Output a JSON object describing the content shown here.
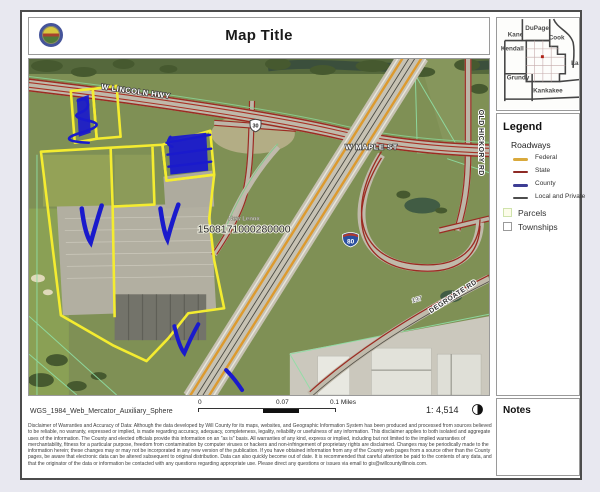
{
  "window": {
    "background": "#e8e8f0"
  },
  "header": {
    "title": "Map Title",
    "seal_icon": "will-county-seal-icon"
  },
  "map": {
    "labels": {
      "lincoln_hwy": "W LINCOLN HWY",
      "maple_st": "W MAPLE ST",
      "old_hickory_rd": "OLD HICKORY RD",
      "degroate_rd": "DEGROATE RD",
      "route_137": "137",
      "township": "New Lenox",
      "parcel_number": "1508171000280000"
    },
    "shields": {
      "us_route": "30",
      "interstate": "80"
    },
    "annotation_color": "#1a1acc",
    "parcel_highlight_color": "#f4ec30"
  },
  "sidebar": {
    "inset": {
      "counties": [
        "DuPage",
        "Kane",
        "Cook",
        "Kendall",
        "Lake",
        "Grundy",
        "Kankakee"
      ],
      "marker_color": "#b02418"
    },
    "legend": {
      "title": "Legend",
      "group_title": "Roadways",
      "roadway_items": [
        {
          "label": "Federal",
          "color": "#d9a93c"
        },
        {
          "label": "State",
          "color": "#8e2a25"
        },
        {
          "label": "County",
          "color": "#3d3d94"
        },
        {
          "label": "Local and Private",
          "color": "#4d4d4d"
        }
      ],
      "parcels_label": "Parcels",
      "townships_label": "Townships"
    },
    "notes": {
      "title": "Notes"
    }
  },
  "footer": {
    "projection": "WGS_1984_Web_Mercator_Auxiliary_Sphere",
    "scale_bar": {
      "start": "0",
      "mid": "0.07",
      "end": "0.1 Miles"
    },
    "scale_ratio": "1: 4,514",
    "north_icon": "north-arrow-icon",
    "disclaimer": "Disclaimer of Warranties and Accuracy of Data: Although the data developed by Will County for its maps, websites, and Geographic Information System has been produced and processed from sources believed to be reliable, no warranty, expressed or implied, is made regarding accuracy, adequacy, completeness, legality, reliability or usefulness of any information. This disclaimer applies to both isolated and aggregate uses of the information. The County and elected officials provide this information on an \"as is\" basis. All warranties of any kind, express or implied, including but not limited to the implied warranties of merchantability, fitness for a particular purpose, freedom from contamination by computer viruses or hackers and non-infringement of proprietary rights are disclaimed. Changes may be periodically made to the information herein; these changes may or may not be incorporated in any new version of the publication. If you have obtained information from any of the County web pages from a source other than the County pages, be aware that electronic data can be altered subsequent to original distribution. Data can also quickly become out of date. It is recommended that careful attention be paid to the contents of any data, and that the originator of the data or information be contacted with any questions regarding appropriate use. Please direct any questions or issues via email to gis@willcountyillinois.com."
  }
}
